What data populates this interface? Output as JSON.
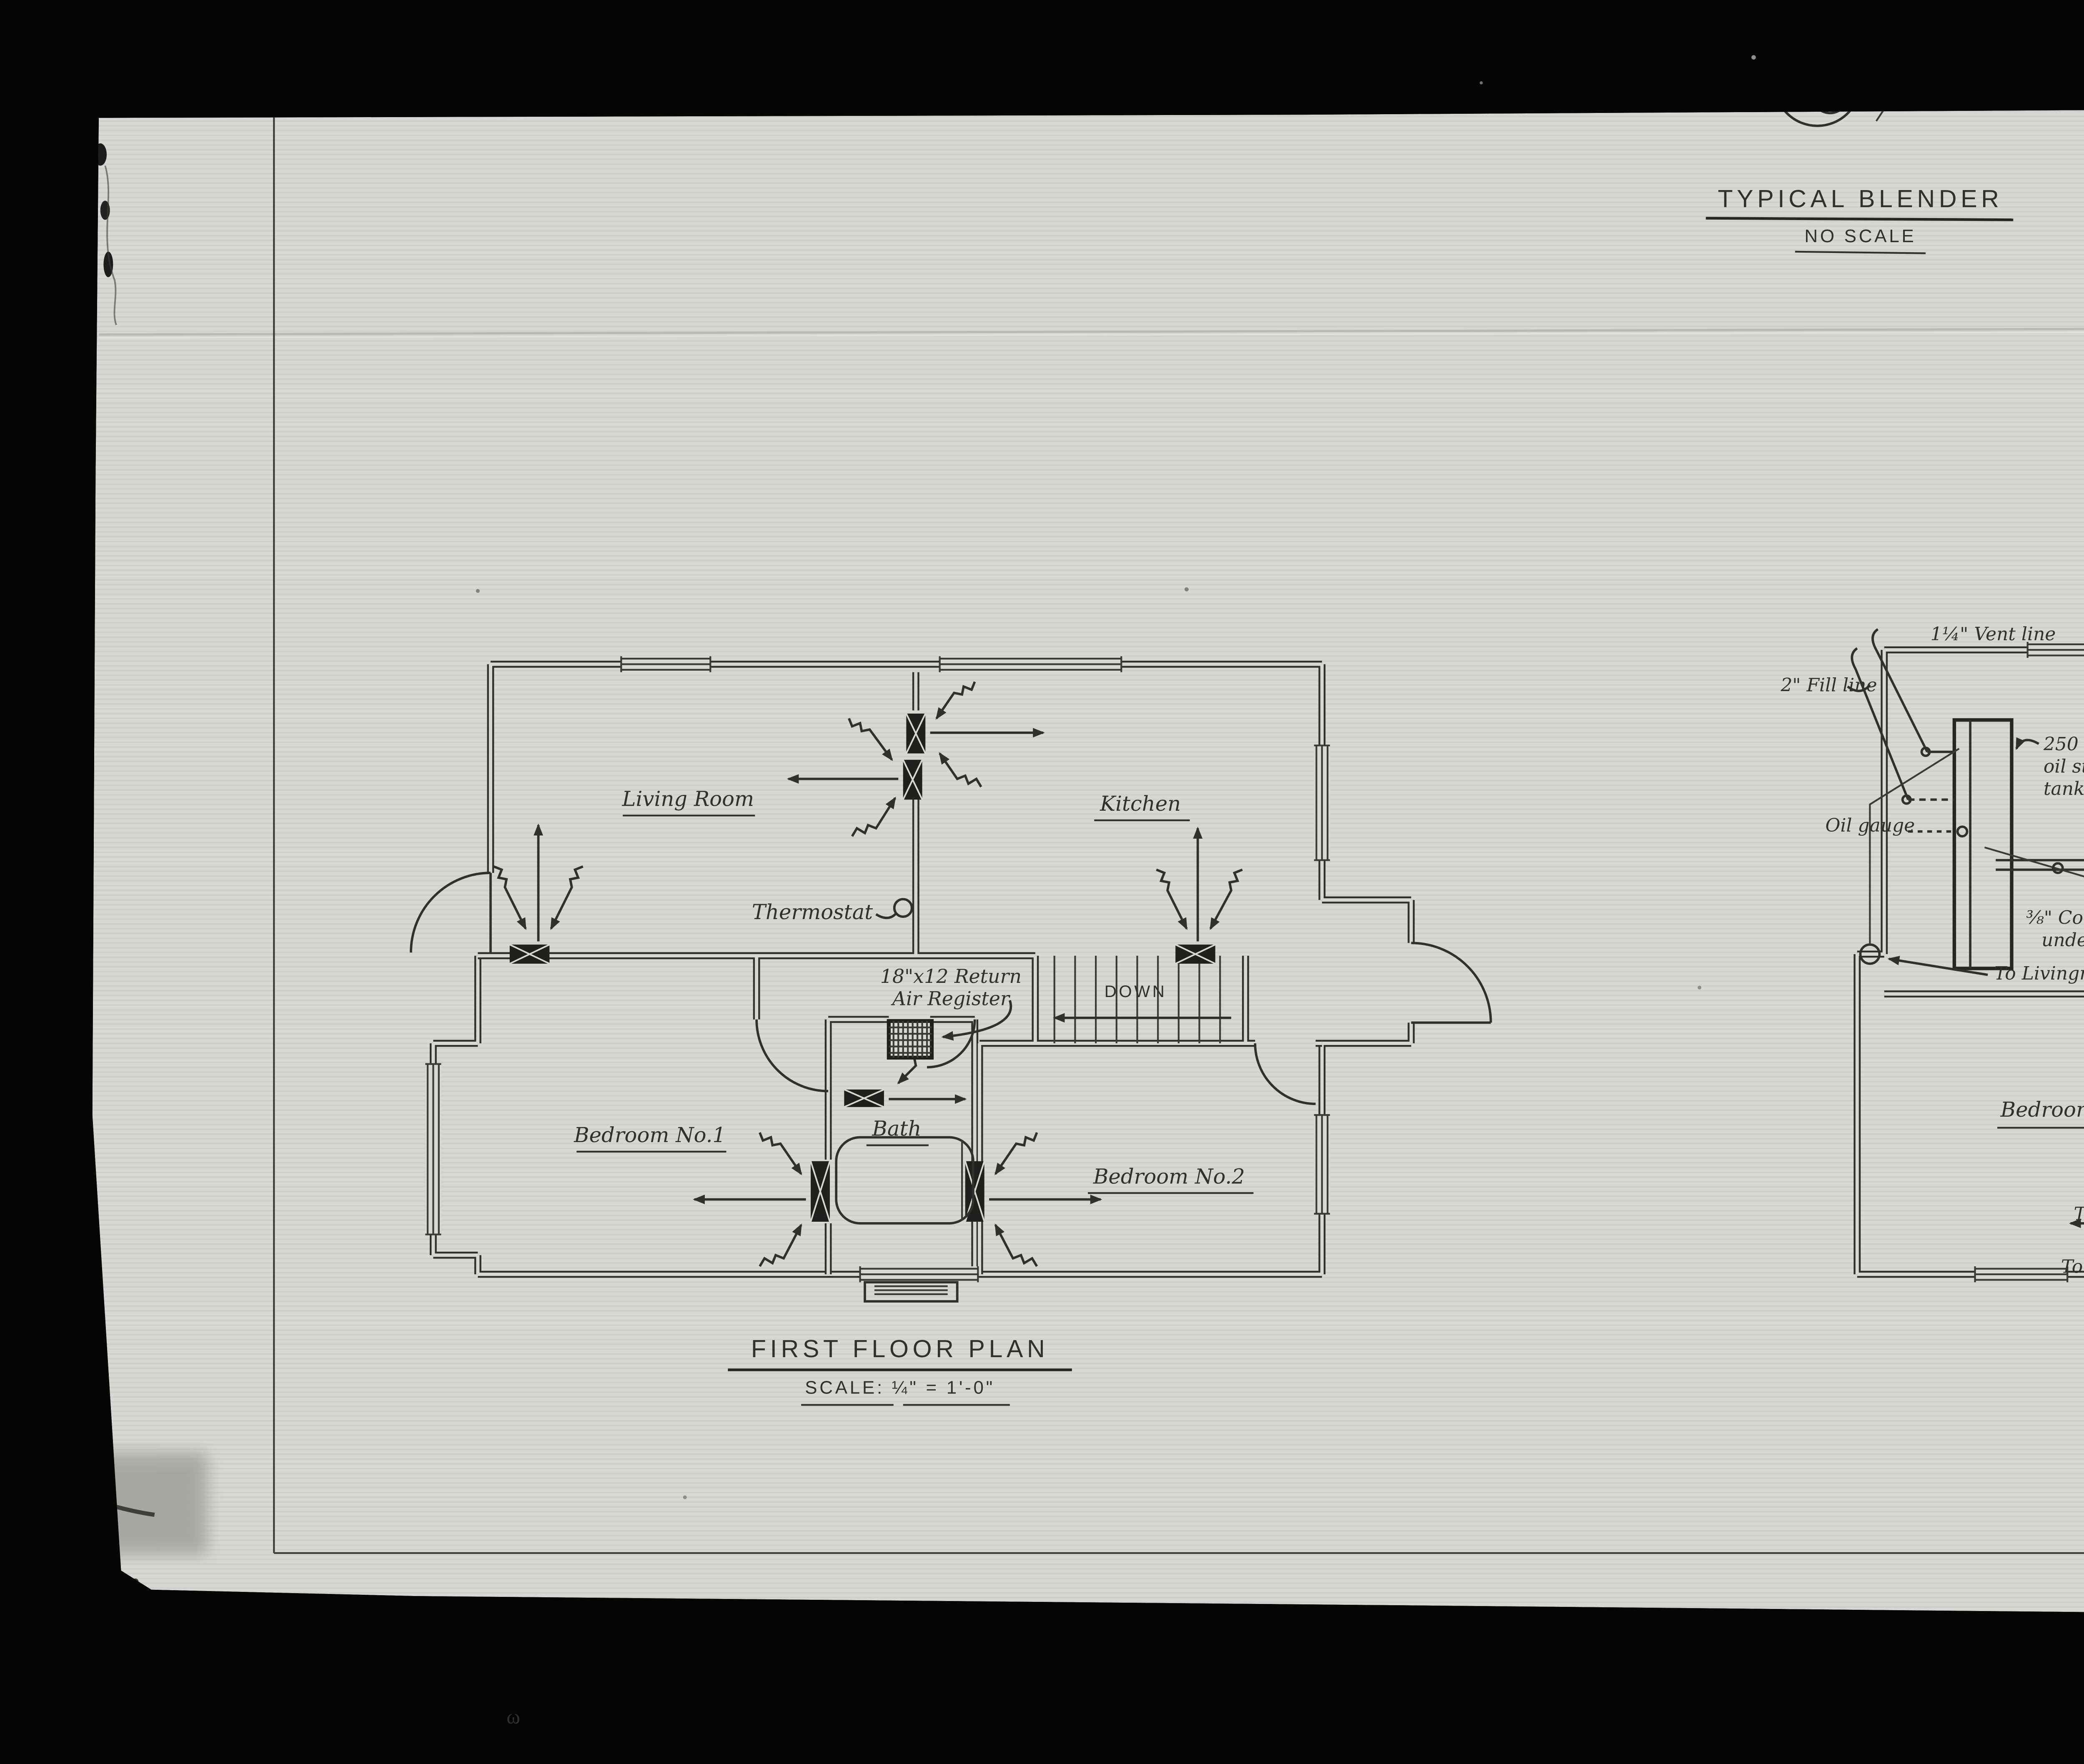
{
  "colors": {
    "background": "#050505",
    "paper": "#d8d7d3",
    "ink": "#30302e",
    "page_label_bg": "#e9e9e6",
    "page_label_text": "#141414"
  },
  "detail_title": {
    "title": "TYPICAL BLENDER",
    "subtitle": "NO SCALE"
  },
  "first_floor": {
    "title": "FIRST FLOOR PLAN",
    "scale": "SCALE: ¼\" = 1'-0\"",
    "rooms": {
      "living_room": "Living Room",
      "kitchen": "Kitchen",
      "bedroom1": "Bedroom No.1",
      "bath": "Bath",
      "bedroom2": "Bedroom No.2"
    },
    "labels": {
      "thermostat": "Thermostat",
      "return_register_line1": "18\"x12 Return",
      "return_register_line2": "Air Register",
      "down": "DOWN"
    }
  },
  "basement": {
    "title_partial": "BASEMENT P",
    "scale_partial": "SCALE: ¼\" = 1'-",
    "labels": {
      "vent_line": "1¼\" Vent line",
      "fill_line": "2\" Fill line",
      "tank_line1": "250 gallon",
      "tank_line2": "oil storage",
      "tank_line3": "tank",
      "oil_gauge": "Oil gauge",
      "to_kitchen": "To Kitchen",
      "to_livingroom_upper": "To Livingroom",
      "duct_height": "3½\"",
      "copper_line1": "⅜\" Copper tube oil line",
      "copper_line2": "under concrete slab",
      "to_livingroom_lower": "To Livingroom",
      "duct_line1": "24\"x7\" Duct",
      "duct_line2": "Line joists where",
      "duct_line3": "possible",
      "duct_vertical": "24\"x7\"",
      "duct_height2": "3½\"",
      "bedroom3": "Bedroom No.3",
      "to_bath_line1": "To Bath",
      "to_bath_line2": "Room",
      "to_bedroom3": "To Bedroom No.3",
      "to_bedroom1": "To Bedroom No.1"
    }
  },
  "page": {
    "page_label": "3 of/de"
  }
}
